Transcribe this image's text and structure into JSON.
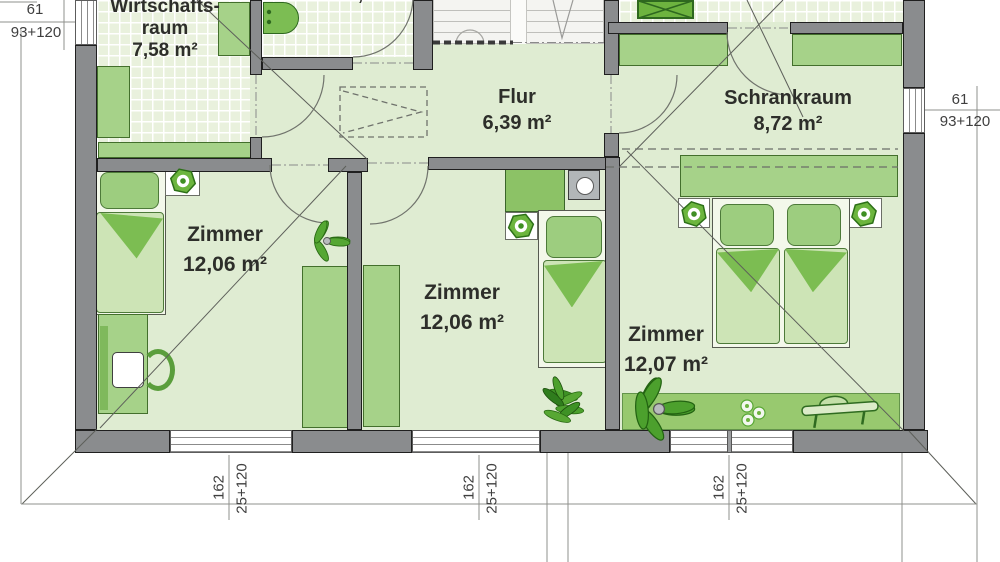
{
  "plan_title": "Grundriss Obergeschoss",
  "rooms": [
    {
      "key": "wirtschaftsraum",
      "line1": "Wirtschafts-",
      "line2": "raum",
      "area": "7,58 m²"
    },
    {
      "key": "bad",
      "line1": "",
      "line2": "",
      "area": "4,76 m²"
    },
    {
      "key": "flur",
      "line1": "Flur",
      "line2": "",
      "area": "6,39 m²"
    },
    {
      "key": "schrankraum",
      "line1": "Schrankraum",
      "line2": "",
      "area": "8,72 m²"
    },
    {
      "key": "zimmer-links",
      "line1": "Zimmer",
      "line2": "",
      "area": "12,06 m²"
    },
    {
      "key": "zimmer-mitte",
      "line1": "Zimmer",
      "line2": "",
      "area": "12,06 m²"
    },
    {
      "key": "zimmer-rechts",
      "line1": "Zimmer",
      "line2": "",
      "area": "12,07 m²"
    }
  ],
  "dimensions": {
    "left_window": {
      "width": "61",
      "detail": "93+120"
    },
    "right_window": {
      "width": "61",
      "detail": "93+120"
    },
    "bottom_windows": [
      {
        "width": "162",
        "detail": "25+120"
      },
      {
        "width": "162",
        "detail": "25+120"
      },
      {
        "width": "162",
        "detail": "25+120"
      }
    ]
  },
  "icons": [
    "toilet-icon",
    "shower-icon",
    "flower-hexagon-icon",
    "plant-icon",
    "flowers-icon",
    "lounger-icon",
    "chimney-icon"
  ],
  "colors": {
    "floor": "#dfecd2",
    "tiles": "#e9f1dd",
    "wall": "#8a8c8e",
    "furniture": "#a6d289",
    "mattress": "#cde4b6",
    "blanket_fold": "#7cbd52",
    "plant": "#4ca02d",
    "linework": "#5d5f5a"
  }
}
